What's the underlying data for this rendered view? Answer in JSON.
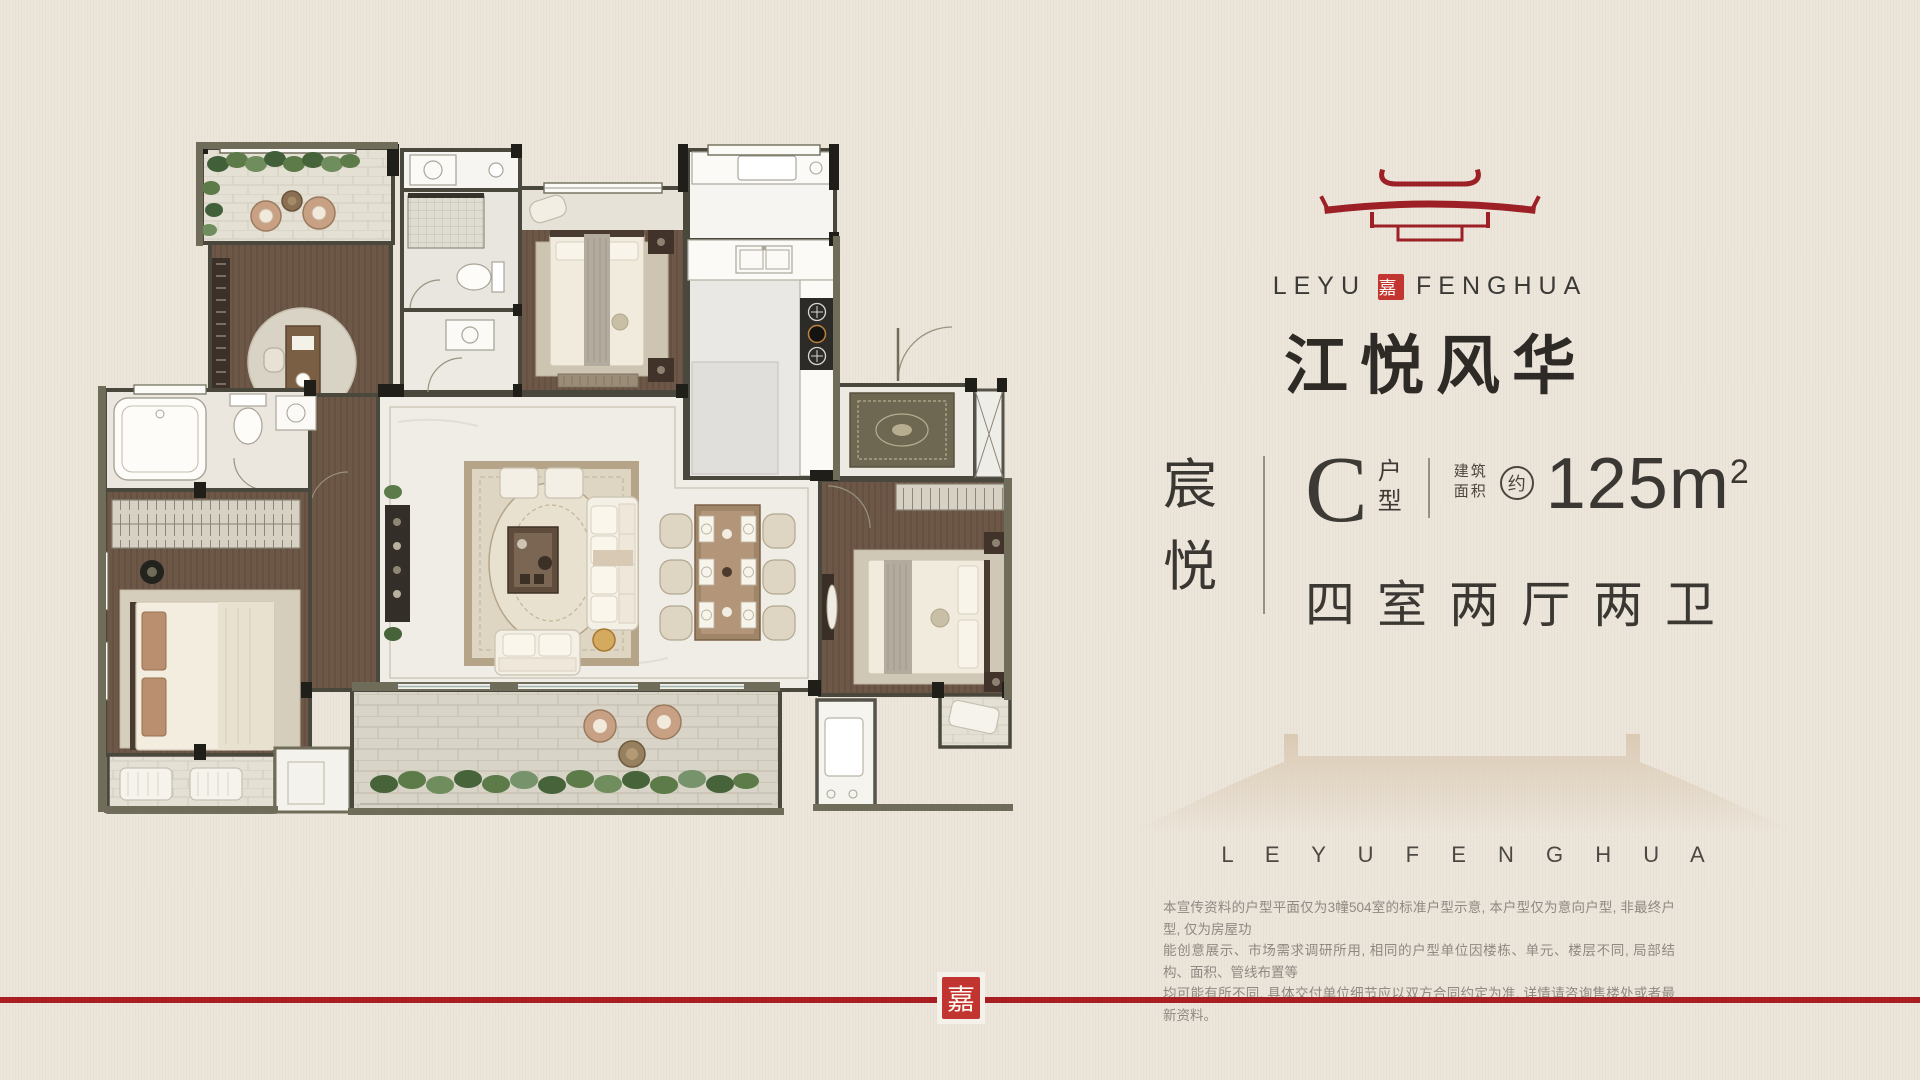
{
  "brand": {
    "latin_left": "LEYU",
    "latin_right": "FENGHUA",
    "seal_character": "嘉",
    "chinese_name": "江悦风华"
  },
  "unit_info": {
    "project_name_chars": [
      "宸",
      "悦"
    ],
    "unit_letter": "C",
    "unit_type_chars": [
      "户",
      "型"
    ],
    "area_label_line1": "建筑",
    "area_label_line2": "面积",
    "area_approx": "约",
    "area_value": "125m",
    "area_exponent": "2",
    "layout_description": "四室两厅两卫"
  },
  "watermark": {
    "text": "L E Y U F E N G H U A"
  },
  "disclaimer": {
    "lines": [
      "本宣传资料的户型平面仅为3幢504室的标准户型示意, 本户型仅为意向户型, 非最终户型, 仅为房屋功",
      "能创意展示、市场需求调研所用, 相同的户型单位因楼栋、单元、楼层不同, 局部结构、面积、管线布置等",
      "均可能有所不同, 具体交付单位细节应以双方合同约定为准, 详情请咨询售楼处或者最新资料。"
    ]
  },
  "footer": {
    "seal_character": "嘉"
  },
  "palette": {
    "background": "#ece5da",
    "brand_red": "#9c2025",
    "seal_red": "#c23531",
    "footer_line_red": "#a81e22",
    "text_dark": "#3b3834",
    "disclaimer_gray": "#8f8983",
    "wall_dark": "#1f1e18",
    "wall_olive": "#6f6d59",
    "wood_floor": "#6d5848",
    "marble_floor": "#f0ede7",
    "balcony_tile": "#e4e0d4",
    "plant_green": "#5c7b49",
    "rattan": "#c8a185"
  }
}
